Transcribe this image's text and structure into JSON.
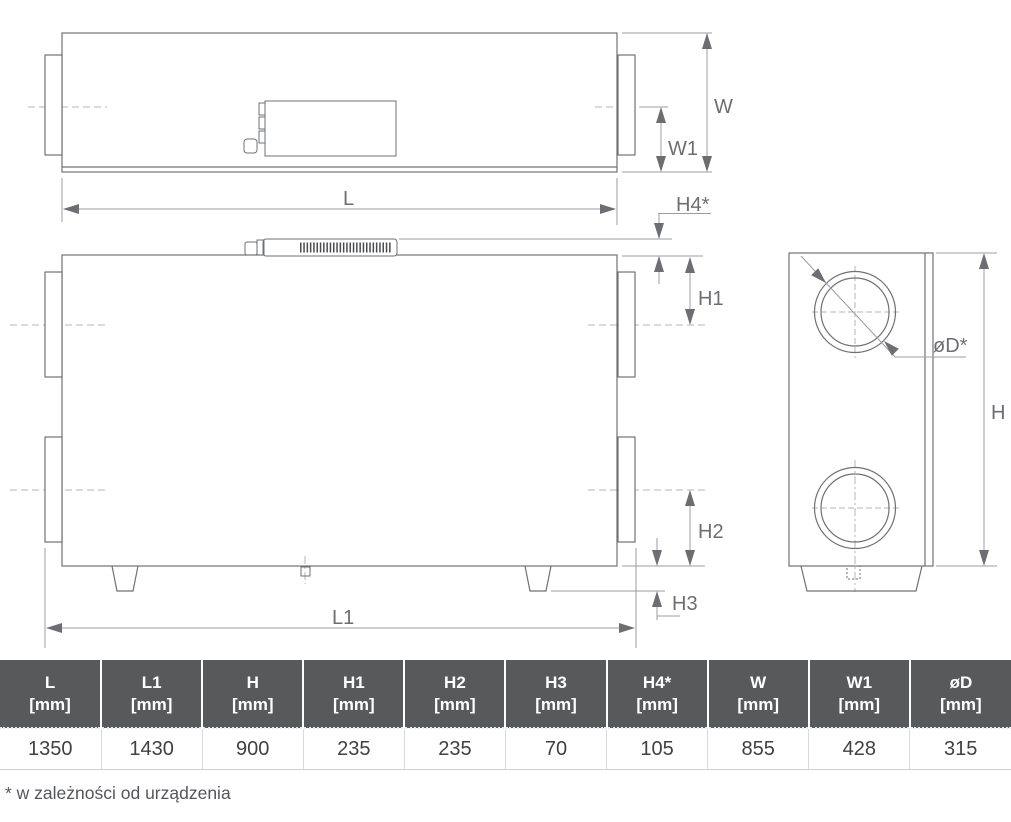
{
  "drawing": {
    "labels": {
      "L": "L",
      "L1": "L1",
      "W": "W",
      "W1": "W1",
      "H": "H",
      "H1": "H1",
      "H2": "H2",
      "H3": "H3",
      "H4": "H4*",
      "D": "øD*"
    },
    "colors": {
      "outline": "#6f7174",
      "dimension_line": "#97999c",
      "arrow": "#6d6e71",
      "label": "#6d6e71",
      "centerline": "#b4b6b8",
      "grille_hatch": "#4a4b4d"
    }
  },
  "table": {
    "header_bg": "#58595b",
    "header_text_color": "#ffffff",
    "value_text_color": "#414042",
    "columns": [
      {
        "name": "L",
        "unit": "[mm]",
        "value": "1350"
      },
      {
        "name": "L1",
        "unit": "[mm]",
        "value": "1430"
      },
      {
        "name": "H",
        "unit": "[mm]",
        "value": "900"
      },
      {
        "name": "H1",
        "unit": "[mm]",
        "value": "235"
      },
      {
        "name": "H2",
        "unit": "[mm]",
        "value": "235"
      },
      {
        "name": "H3",
        "unit": "[mm]",
        "value": "70"
      },
      {
        "name": "H4*",
        "unit": "[mm]",
        "value": "105"
      },
      {
        "name": "W",
        "unit": "[mm]",
        "value": "855"
      },
      {
        "name": "W1",
        "unit": "[mm]",
        "value": "428"
      },
      {
        "name": "øD",
        "unit": "[mm]",
        "value": "315"
      }
    ]
  },
  "footnote": "* w zależności od urządzenia"
}
